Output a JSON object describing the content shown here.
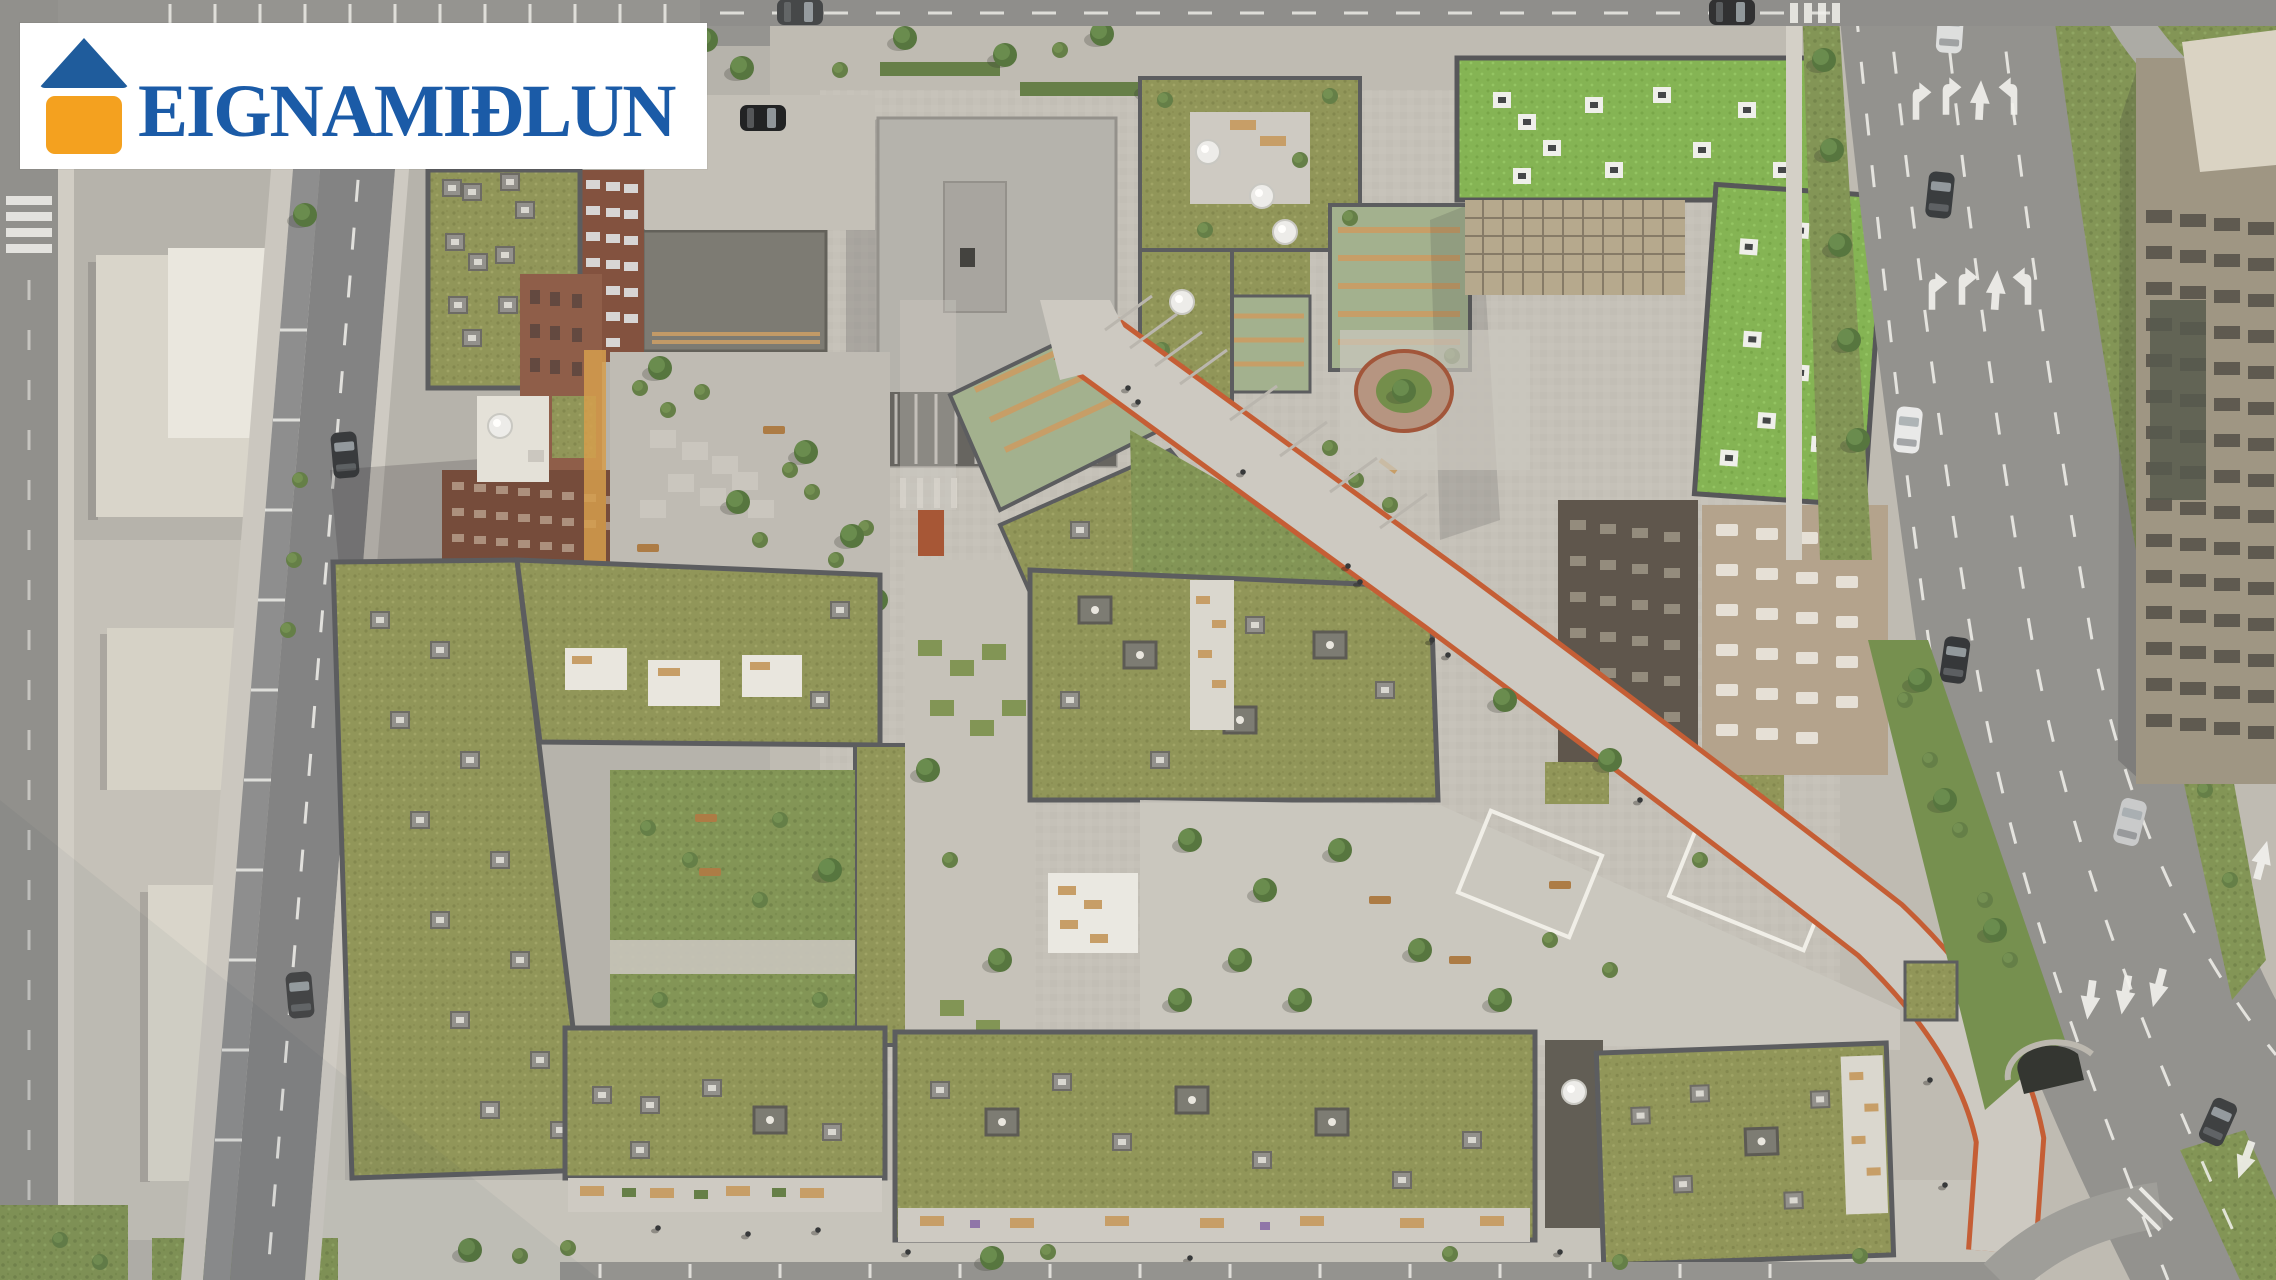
{
  "logo": {
    "text": "EIGNAMIÐLUN",
    "icon": "house-icon",
    "colors": {
      "background": "#FFFFFF",
      "roof_blue": "#1F5C9C",
      "wall_orange": "#F4A11F",
      "text_blue": "#1B5BA7"
    }
  },
  "scene": {
    "description": "Aerial 3D rendering of a residential development: apartment blocks with green roofs around courtyards, a diagonal pedestrian promenade edged in orange, local street with parking, and a multi-lane boulevard with lane arrows and cars",
    "palette": {
      "pavement": "#BCB9B2",
      "plaza": "#C9C6BF",
      "local_street": "#7D7E80",
      "boulevard": "#8E8E8C",
      "roof_green_olive": "#8C9254",
      "roof_green_bright": "#7FB14E",
      "courtyard_grass": "#7D9151",
      "brick": "#8A5743",
      "pale_building": "#D7D4CB",
      "promenade_line_orange": "#C2572E",
      "road_marking_white": "#F2F2EF"
    }
  }
}
